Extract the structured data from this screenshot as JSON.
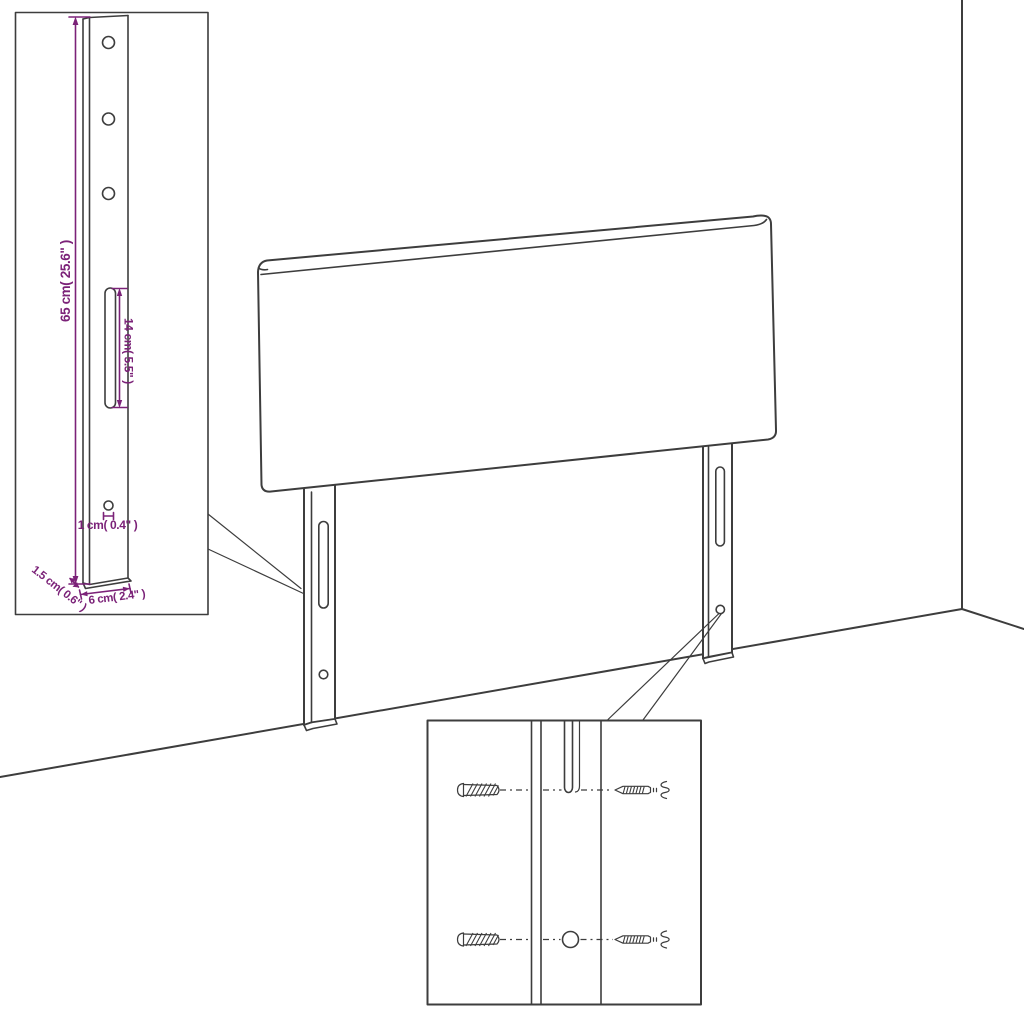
{
  "colors": {
    "line": "#3d3d3d",
    "dim": "#7b2278",
    "bg": "#ffffff"
  },
  "bracket_detail": {
    "height_label": "65 cm( 25.6\" )",
    "slot_label": "14 cm( 5.5\" )",
    "hole_label": "1 cm( 0.4\" )",
    "thickness_label": "1.5 cm( 0.6\" )",
    "width_label": "6 cm( 2.4\" )"
  }
}
